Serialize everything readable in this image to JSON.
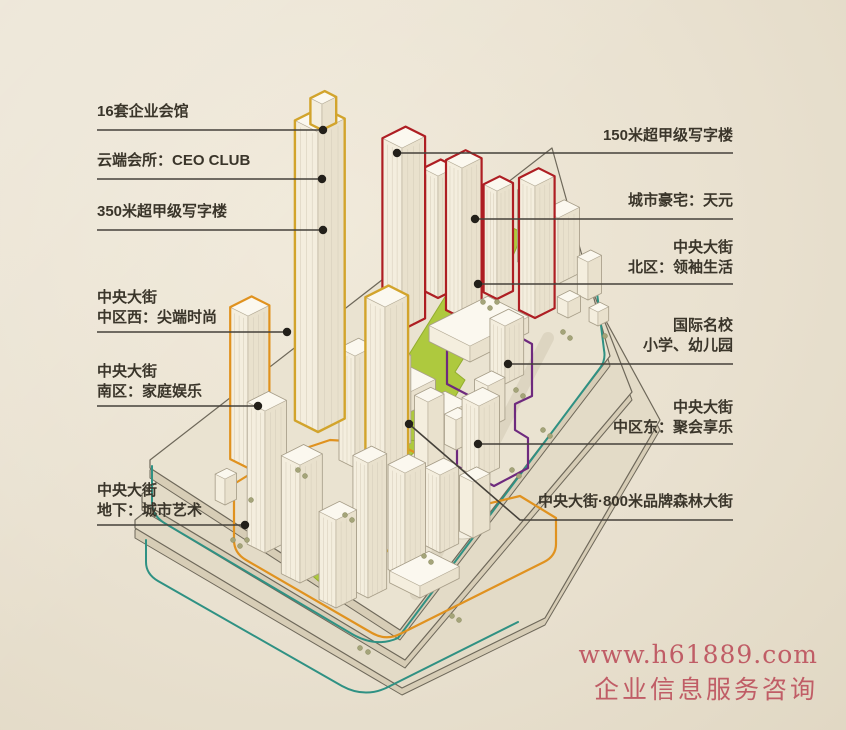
{
  "callouts": {
    "left": [
      {
        "id": "club-houses",
        "lines": [
          "16套企业会馆"
        ]
      },
      {
        "id": "ceo-club",
        "lines": [
          "云端会所：CEO CLUB"
        ]
      },
      {
        "id": "tower-350m",
        "lines": [
          "350米超甲级写字楼"
        ]
      },
      {
        "id": "central-west",
        "lines": [
          "中央大街",
          "中区西：尖端时尚"
        ]
      },
      {
        "id": "south-zone",
        "lines": [
          "中央大街",
          "南区：家庭娱乐"
        ]
      },
      {
        "id": "underground",
        "lines": [
          "中央大街",
          "地下：城市艺术"
        ]
      }
    ],
    "right": [
      {
        "id": "tower-150m",
        "lines": [
          "150米超甲级写字楼"
        ]
      },
      {
        "id": "city-mansion",
        "lines": [
          "城市豪宅：天元"
        ]
      },
      {
        "id": "north-zone",
        "lines": [
          "中央大街",
          "北区：领袖生活"
        ]
      },
      {
        "id": "intl-school",
        "lines": [
          "国际名校",
          "小学、幼儿园"
        ]
      },
      {
        "id": "central-east",
        "lines": [
          "中央大街",
          "中区东：聚会享乐"
        ]
      },
      {
        "id": "forest-street",
        "lines": [
          "中央大街·800米品牌森林大街"
        ]
      }
    ]
  },
  "watermark": {
    "url": "www.h61889.com",
    "caption": "企业信息服务咨询"
  },
  "colors": {
    "gold": "#d2a42c",
    "red": "#ae1e23",
    "orange": "#e0921f",
    "purple": "#6e2a7e",
    "teal": "#2f9183",
    "green": "#aec93e",
    "ink": "#3a352a",
    "line": "#45413a",
    "watermark": "#c05d66"
  }
}
